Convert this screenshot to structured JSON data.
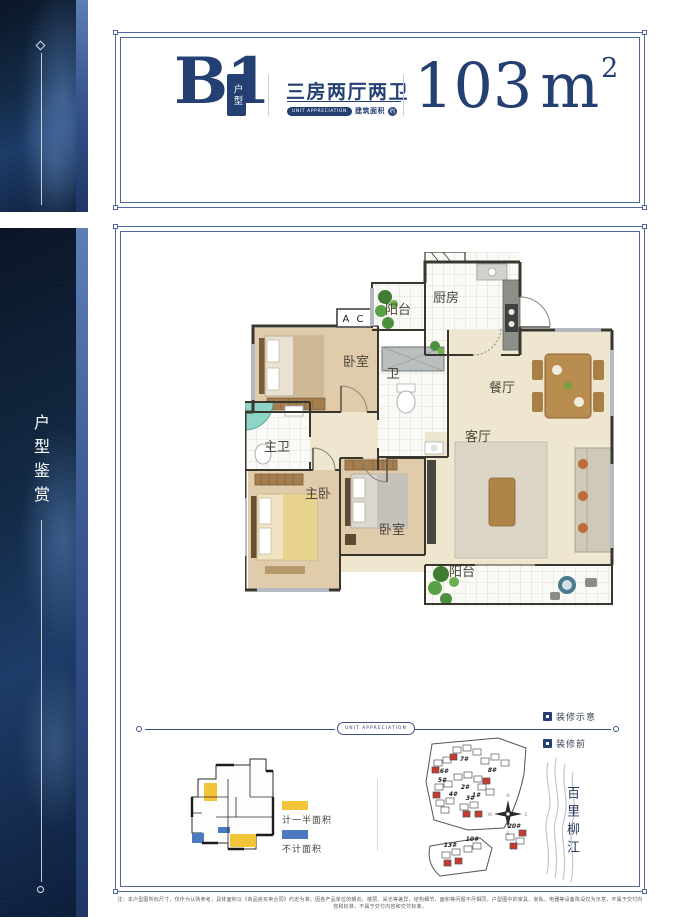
{
  "colors": {
    "accent": "#244072",
    "half_area": "#f3c338",
    "excluded_area": "#4d79be",
    "highlight": "#c8392e"
  },
  "sidebar": {
    "vertical_title": "户型鉴赏"
  },
  "header": {
    "unit_code": "B1",
    "unit_badge": "户型",
    "layout_type": "三房两厅两卫",
    "tagline": "UNIT APPRECIATION",
    "area_prefix": "建筑面积",
    "area_approx": "约",
    "area_value": "103",
    "area_unit": "m",
    "area_exponent": "2"
  },
  "floor_plan": {
    "rooms": [
      {
        "name": "balcony-top",
        "label": "阳台"
      },
      {
        "name": "kitchen",
        "label": "厨房"
      },
      {
        "name": "ac-platform",
        "label": "A C"
      },
      {
        "name": "bedroom-2",
        "label": "卧室"
      },
      {
        "name": "bathroom",
        "label": "卫"
      },
      {
        "name": "dining-room",
        "label": "餐厅"
      },
      {
        "name": "living-room",
        "label": "客厅"
      },
      {
        "name": "master-bathroom",
        "label": "主卫"
      },
      {
        "name": "master-bedroom",
        "label": "主卧"
      },
      {
        "name": "bedroom-3",
        "label": "卧室"
      },
      {
        "name": "balcony-bottom",
        "label": "阳台"
      }
    ]
  },
  "section_divider": {
    "tagline": "UNIT APPRECIATION"
  },
  "annotations": {
    "decor_demo": "装修示意",
    "decor_before": "装修前"
  },
  "legend": {
    "half_area_label": "计一半面积",
    "excluded_area_label": "不计面积"
  },
  "site_plan": {
    "river_name": "百里柳江",
    "compass": {
      "n": "N",
      "e": "E",
      "s": "S",
      "w": "W"
    },
    "buildings": [
      {
        "label": "6#"
      },
      {
        "label": "7#"
      },
      {
        "label": "8#"
      },
      {
        "label": "5#"
      },
      {
        "label": "2#"
      },
      {
        "label": "1#"
      },
      {
        "label": "4#"
      },
      {
        "label": "3#"
      },
      {
        "label": "13#"
      },
      {
        "label": "10#"
      },
      {
        "label": "20#"
      }
    ]
  },
  "footer": {
    "disclaimer": "注：本户型图所标尺寸，仅作为认购参考，具体面积以《商品房买卖合同》约定为准。因各产品单位的朝向、楼层、采光等差异，结构细节、面积等问题不尽相同，户型图中的家具、家私、电器等设备陈设仅为示意，不属于交付内容和标准，不属于交付内容和交付标准。"
  }
}
